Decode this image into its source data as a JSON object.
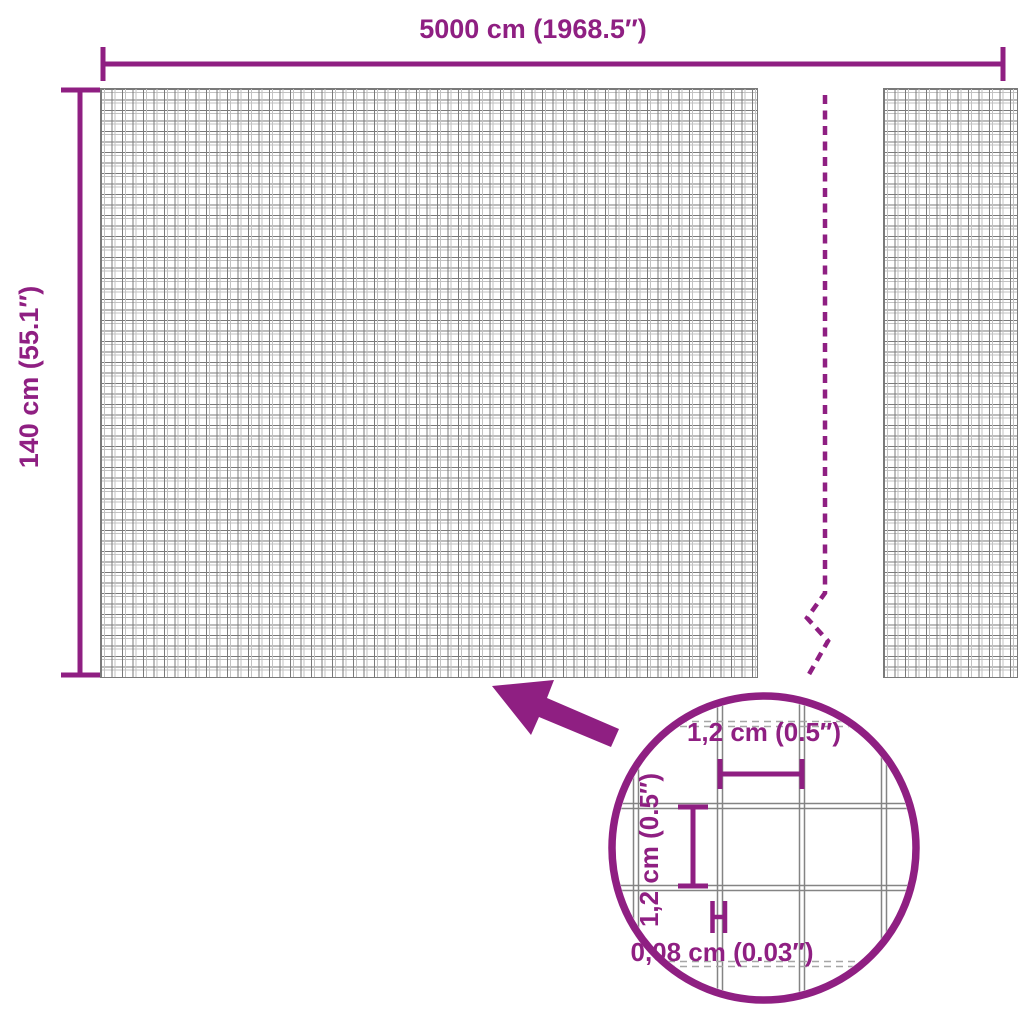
{
  "diagram": {
    "accent_color": "#8F1F82",
    "mesh_line_color": "#7A7A7A",
    "overall": {
      "width_label": "5000 cm (1968.5″)",
      "height_label": "140 cm (55.1″)"
    },
    "detail": {
      "cell_width_label": "1,2 cm (0.5″)",
      "cell_height_label": "1,2 cm (0.5″)",
      "wire_thickness_label": "0,08 cm (0.03″)"
    }
  }
}
